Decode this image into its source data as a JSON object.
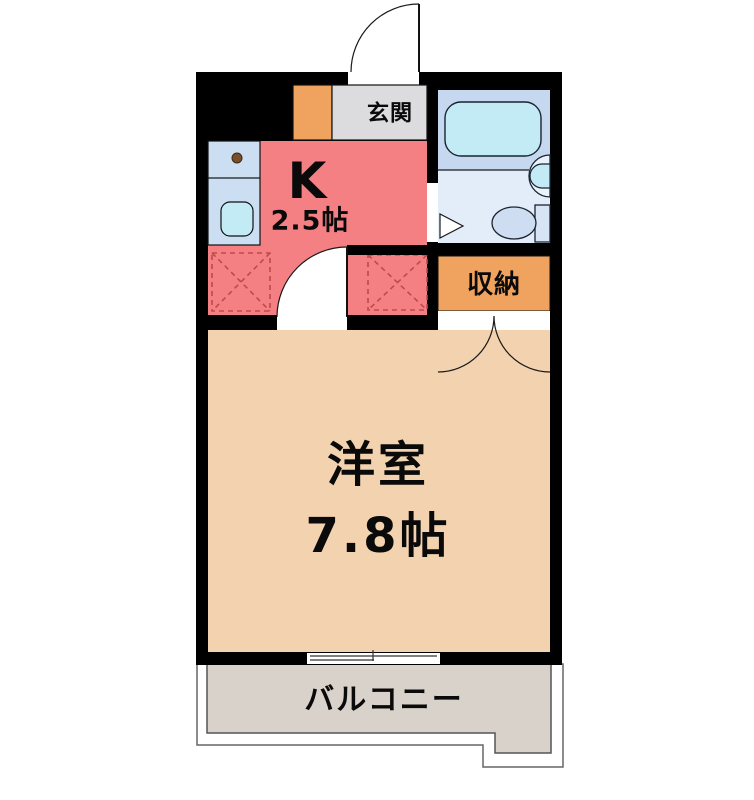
{
  "plan": {
    "rooms": {
      "entrance": {
        "label": "玄関"
      },
      "kitchen": {
        "label": "K",
        "size": "2.5帖"
      },
      "storage": {
        "label": "収納"
      },
      "western_room": {
        "label": "洋室",
        "size": "7.8帖"
      },
      "balcony": {
        "label": "バルコニー"
      }
    },
    "fixtures": [
      "entrance-door",
      "kitchen-counter",
      "kitchen-sink",
      "burner-dot",
      "bathtub",
      "washbasin",
      "toilet",
      "bathroom-door-marker",
      "appliance-space-left",
      "appliance-space-right",
      "storage-double-doors",
      "room-door",
      "sliding-window"
    ]
  },
  "colors": {
    "wall": "#000000",
    "kitchen": "#F58084",
    "entrance_gray": "#DCDCDE",
    "storage_orange": "#F0A35F",
    "room_tan": "#F3D2AF",
    "balcony_gray": "#D9D2CB",
    "bath_upper": "#C5D8F0",
    "bath_lower": "#E3EDFA",
    "fixture_cyan": "#C2EBF6",
    "counter_blue": "#CBDEF2",
    "toilet_blue": "#CEDDF1",
    "tank_blue": "#D6E4F6",
    "dashed_red": "#BE4A4A",
    "burner_brown": "#7A4E2A",
    "white": "#FFFFFF"
  }
}
